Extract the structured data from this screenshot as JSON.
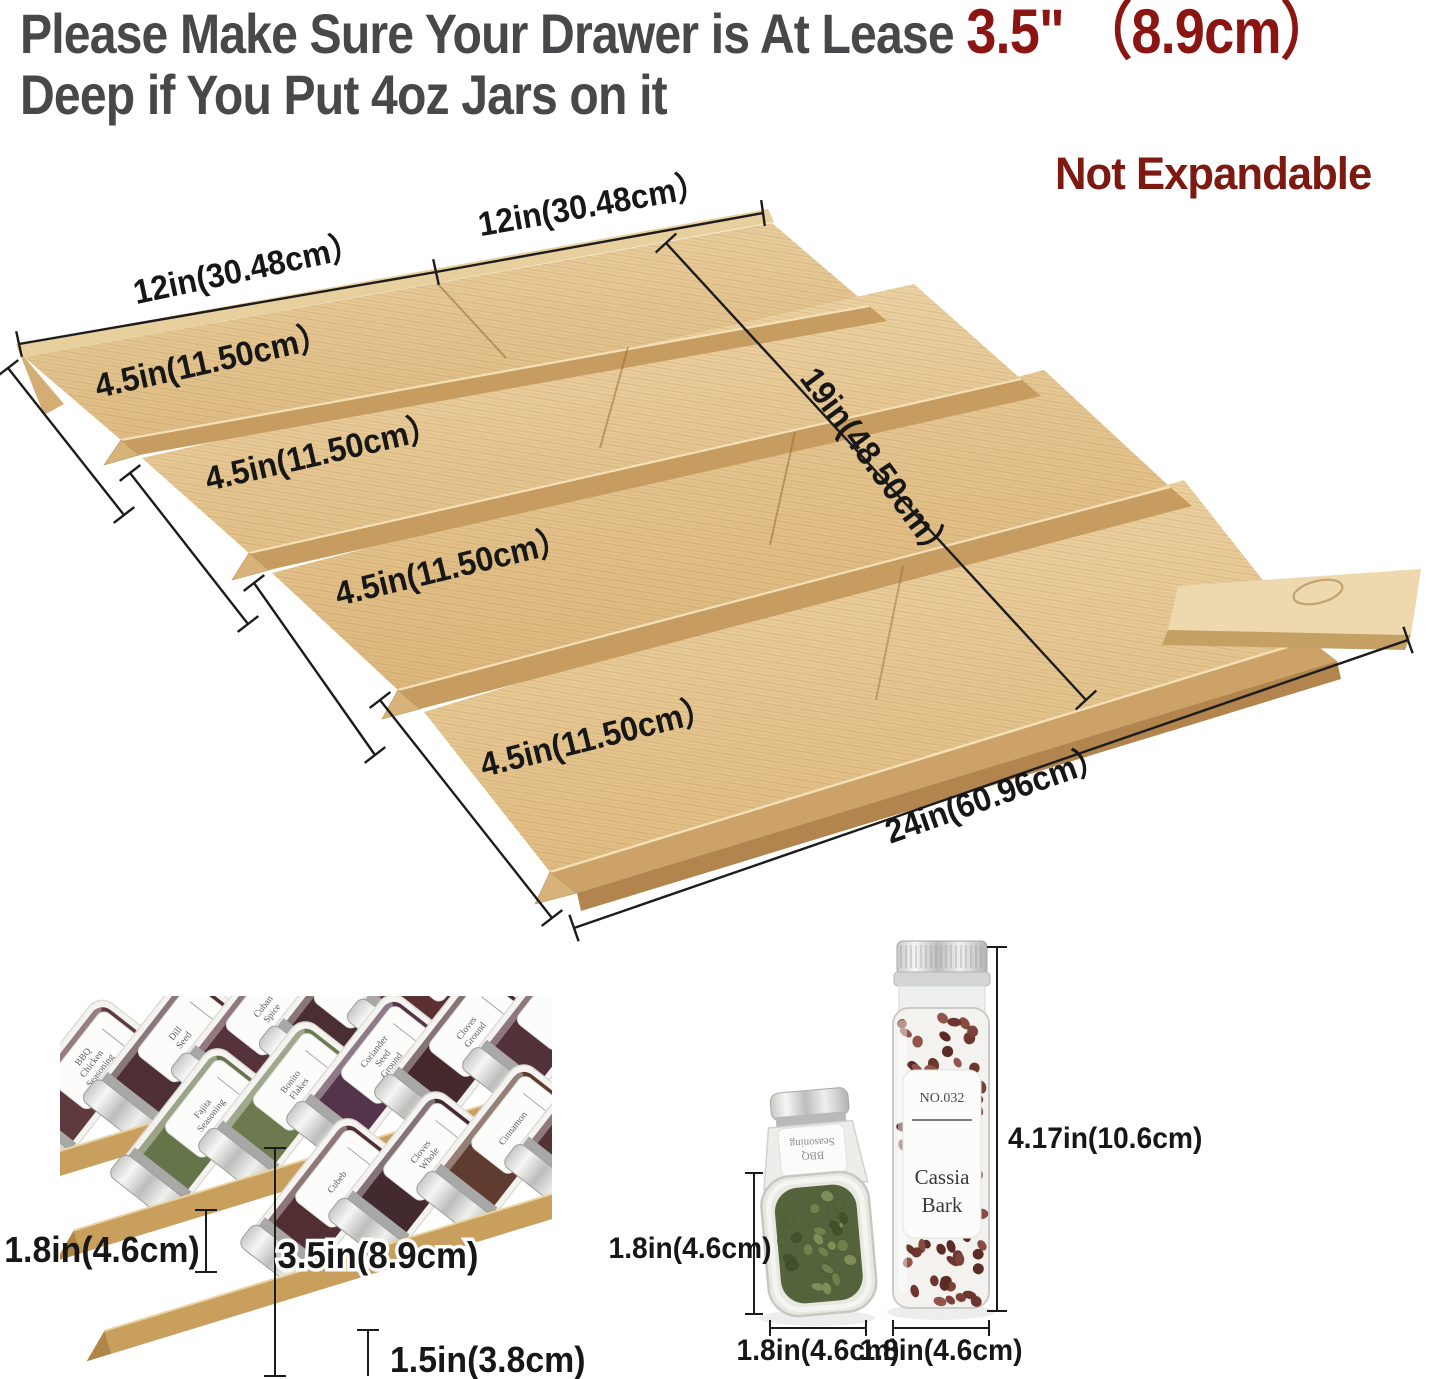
{
  "header": {
    "line1_prefix": "Please Make Sure Your Drawer is At Lease ",
    "line1_highlight": "3.5\" （8.9cm）",
    "line2": "Deep if You Put 4oz Jars on it",
    "text_color": "#48484b",
    "highlight_color": "#8a1512"
  },
  "badge": {
    "label": "Not Expandable",
    "color": "#7c1a12"
  },
  "organizer": {
    "dim_width_left": "12in(30.48cm）",
    "dim_width_right": "12in(30.48cm）",
    "tier_dims": [
      "4.5in(11.50cm）",
      "4.5in(11.50cm）",
      "4.5in(11.50cm）",
      "4.5in(11.50cm）"
    ],
    "dim_depth": "19in(48.50cm）",
    "dim_total_width": "24in(60.96cm）",
    "wood_light": "#eed7aa",
    "wood_dark": "#ddb981",
    "ridge_color": "#c69c61",
    "edge_color": "#b2854e"
  },
  "left_photo": {
    "dim_back_height": "1.8in(4.6cm)",
    "dim_jar_height": "3.5in(8.9cm)",
    "dim_lip_height": "1.5in(3.8cm)",
    "rows": [
      {
        "jars": [
          {
            "label": "BBQ Chicken Seasoning",
            "fill": "#5e3a3c"
          },
          {
            "label": "Dill Seed",
            "fill": "#4e3034"
          },
          {
            "label": "Cuban Spice",
            "fill": "#56323a"
          },
          {
            "label": "",
            "fill": "#4a2e31"
          },
          {
            "label": "Chili Pepper",
            "fill": "#5c2f33"
          }
        ]
      },
      {
        "jars": [
          {
            "label": "Fajita Seasoning",
            "fill": "#66744a"
          },
          {
            "label": "Bonito Flakes",
            "fill": "#6d7a50"
          },
          {
            "label": "Coriander Seed Ground",
            "fill": "#53344a"
          },
          {
            "label": "Cloves Ground",
            "fill": "#46292c"
          },
          {
            "label": "",
            "fill": "#533138"
          }
        ]
      },
      {
        "jars": [
          {
            "label": "Cubeb",
            "fill": "#502e31"
          },
          {
            "label": "Cloves Whole",
            "fill": "#432a2e"
          },
          {
            "label": "Cinnamon",
            "fill": "#5f3b30"
          },
          {
            "label": "",
            "fill": "#543236"
          }
        ]
      }
    ]
  },
  "right_photo": {
    "short_jar": {
      "label_line1": "BBQ",
      "label_line2": "Seasoning"
    },
    "tall_jar": {
      "no": "NO.032",
      "name_line1": "Cassia",
      "name_line2": "Bark"
    },
    "dim_short_height": "1.8in(4.6cm)",
    "dim_short_width": "1.8in(4.6cm)",
    "dim_tall_height": "4.17in(10.6cm)",
    "dim_tall_width": "1.8in(4.6cm)",
    "bean_colors_red": [
      "#8a4a40",
      "#6d362e",
      "#93544a",
      "#5d2b26",
      "#7c4138"
    ],
    "bean_colors_green": [
      "#72814c",
      "#55643a",
      "#7f8f58",
      "#44522c"
    ]
  }
}
